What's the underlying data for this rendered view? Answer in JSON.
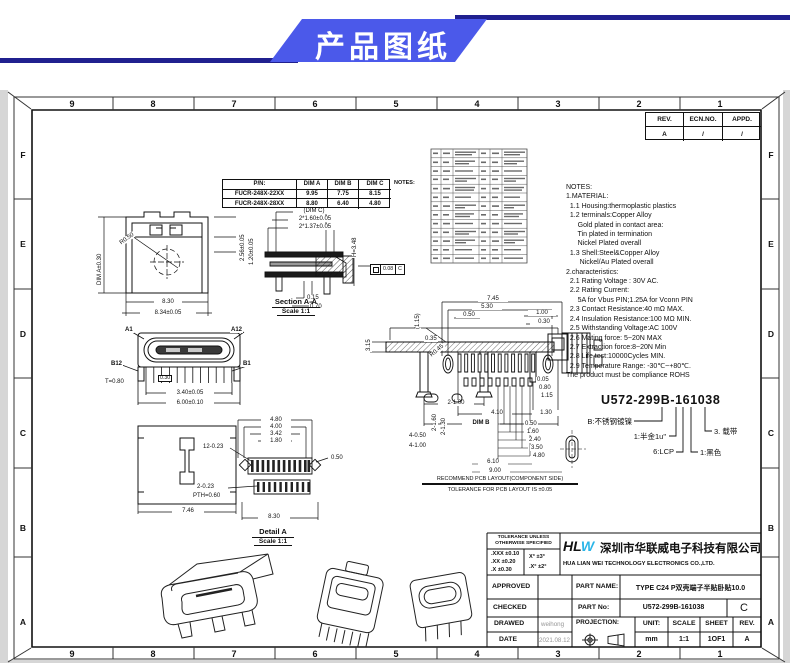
{
  "banner": {
    "title": "产品图纸"
  },
  "zones": {
    "cols": [
      "9",
      "8",
      "7",
      "6",
      "5",
      "4",
      "3",
      "2",
      "1"
    ],
    "rows": [
      "F",
      "E",
      "D",
      "C",
      "B",
      "A"
    ]
  },
  "rev_table": {
    "h0": "REV.",
    "h1": "ECN.NO.",
    "h2": "APPD.",
    "r0": "A",
    "r1": "/",
    "r2": "/"
  },
  "pn_table": {
    "h0": "P/N:",
    "h1": "DIM A",
    "h2": "DIM B",
    "h3": "DIM C",
    "side": "NOTES:",
    "r00": "FUCR-248X-22XX",
    "r01": "9.95",
    "r02": "7.75",
    "r03": "8.15",
    "r10": "FUCR-248X-28XX",
    "r11": "8.80",
    "r12": "6.40",
    "r13": "4.80"
  },
  "notes": {
    "text": "NOTES:\n1.MATERIAL:\n  1.1 Housing:thermoplastic plastics\n  1.2 terminals:Copper Alloy\n      Gold plated in contact area:\n      Tin plated in termination\n      Nickel Plated overall\n  1.3 Shell:Steel&Copper Alloy\n       Nickel/Au Plated overall\n2.characteristics:\n  2.1 Rating Voltage : 30V AC.\n  2.2 Rating Current:\n      5A for Vbus PIN;1.25A for Vconn PIN\n  2.3 Contact Resistance:40 mΩ MAX.\n  2.4 Insulation Resistance:100 MΩ MIN.\n  2.5 Withstanding Voltage:AC 100V\n  2.6 Mating force: 5~20N MAX\n  2.7 Extraction force:8~20N Min\n  2.8 Life test:10000Cycles MIN.\n  2.9 Temperature Range: -30℃~+80℃.\nThe product must be compliance ROHS"
  },
  "part_code": {
    "code": "U572-299B-161038",
    "c_shell": "B:不锈钢镀镍",
    "c_gold": "1:半金1u\"",
    "c_lcp": "6:LCP",
    "c_black": "1:黑色",
    "c_tape": "3. 载带"
  },
  "views": {
    "front": {
      "d_a": "DIM A±0.30",
      "d1": "2.56±0.05",
      "d2": "1.20±0.05",
      "d3": "R0.50",
      "d4": "8.30",
      "d5": "8.34±0.05"
    },
    "section": {
      "cap": "Section A-A",
      "scale": "Scale 1:1",
      "d1": "(DIM C)",
      "d2": "2*1.60±0.05",
      "d3": "2*1.37±0.05",
      "d4": "H=3.48",
      "d5": "0.15",
      "d6": "0.70",
      "gdt_val": "0.08",
      "gdt_ref": "C"
    },
    "face": {
      "a1": "A1",
      "a12": "A12",
      "b12": "B12",
      "b1": "B1",
      "d1": "T=0.80",
      "d2": "0.30",
      "d3": "3.40±0.05",
      "d4": "6.00±0.10"
    },
    "side": {
      "d1": "6.30",
      "d2": "3.15",
      "d3": "2-1.00",
      "d4": "4.10",
      "d5": "1.30",
      "d6": "DIM B"
    },
    "top": {
      "d1": "7.46"
    },
    "detail": {
      "cap": "Detail A",
      "scale": "Scale 1:1",
      "d1": "12-0.23",
      "d2": "0.50",
      "d3": "2-0.23",
      "d4": "PTH=0.60",
      "d5": "8.30",
      "t1": "4.80",
      "t2": "4.00",
      "t3": "3.42",
      "t4": "1.80"
    },
    "pcb": {
      "cap1": "RECOMMEND PCB LAYOUT(COMPONENT SIDE)",
      "cap2": "TOLERANCE FOR PCB LAYOUT IS ±0.05",
      "d1": "7.45",
      "d2": "5.30",
      "d3": "0.50",
      "d4": "1.00",
      "d5": "0.30",
      "d6": "(1.15)",
      "d7": "0.35",
      "d8": "R0.45",
      "d9": "0.05",
      "d10": "0.80",
      "d11": "1.15",
      "d12": "0.50",
      "d13": "1.60",
      "d14": "2.40",
      "d15": "3.50",
      "d16": "4.80",
      "d17": "6.10",
      "d18": "9.00",
      "d19": "2-1.60",
      "d20": "2-1.30",
      "d21": "4-0.50",
      "d22": "4-1.00"
    }
  },
  "title_block": {
    "tol_header": "TOLERANCE UNLESS\nOTHERWISE SPECIFIED",
    "tol_l1": ".XXX ±0.10",
    "tol_l2": ".XX  ±0.20",
    "tol_l3": ".X   ±0.30",
    "tol_r1": "X°  ±3°",
    "tol_r2": ".X° ±2°",
    "logo_hl": "HL",
    "logo_w": "W",
    "company_cn": "深圳市华联威电子科技有限公司",
    "company_en": "HUA LIAN WEI TECHNOLOGY ELECTRONICS CO.,LTD.",
    "approved": "APPROVED",
    "checked": "CHECKED",
    "drawed": "DRAWED",
    "date": "DATE",
    "drawed_value": "weihong",
    "date_value": "2021.08.12",
    "part_name_label": "PART NAME:",
    "part_name_value": "TYPE C24 P双壳端子半贴卧贴10.0",
    "part_no_label": "PART No:",
    "part_no_value": "U572-299B-161038",
    "rev_letter": "C",
    "projection_label": "PROJECTION:",
    "unit_label": "UNIT:",
    "unit_value": "mm",
    "scale_label": "SCALE",
    "scale_value": "1:1",
    "sheet_label": "SHEET",
    "sheet_value": "1OF1",
    "rev_label": "REV.",
    "rev_value": "A"
  },
  "colors": {
    "banner_blue": "#4b59ea",
    "navy": "#20208f",
    "logo_cyan": "#2ab5e8"
  }
}
